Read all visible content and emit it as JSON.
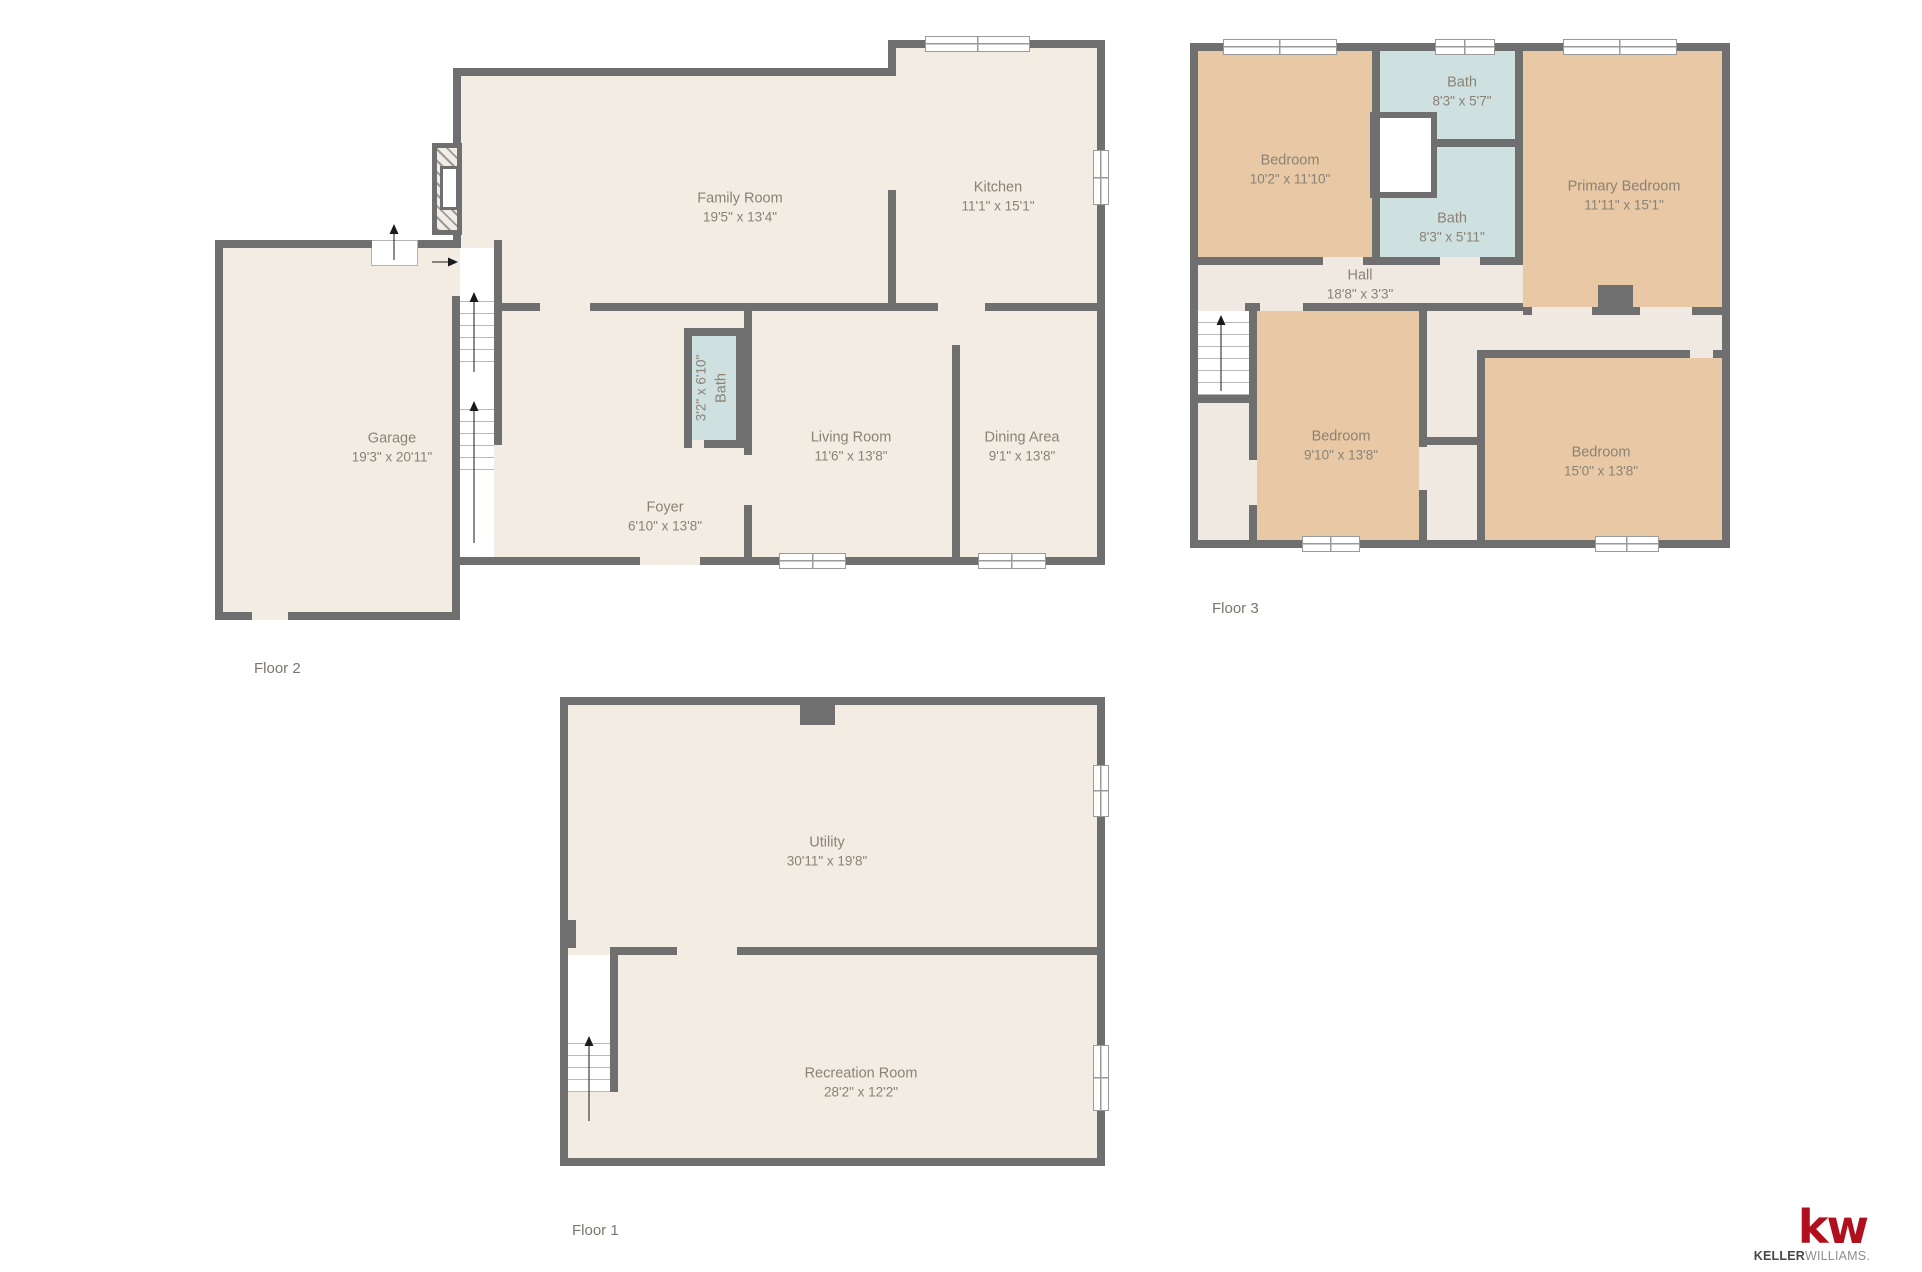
{
  "colors": {
    "wall": "#6f6f6f",
    "room_fill": "#f2ece3",
    "circulation_fill": "#efe9e1",
    "bedroom_fill": "#e9c9a5",
    "bath_fill": "#cfe0e1",
    "label_text": "#8b8275",
    "floor_label_text": "#7c766c",
    "kw_red": "#b0101e"
  },
  "floors": {
    "floor1": {
      "label": "Floor 1"
    },
    "floor2": {
      "label": "Floor 2"
    },
    "floor3": {
      "label": "Floor 3"
    }
  },
  "rooms": {
    "family_room": {
      "name": "Family Room",
      "dims": "19'5\" x 13'4\""
    },
    "kitchen": {
      "name": "Kitchen",
      "dims": "11'1\" x 15'1\""
    },
    "bath_f2": {
      "name": "Bath",
      "dims": "3'2\" x 6'10\""
    },
    "living_room": {
      "name": "Living Room",
      "dims": "11'6\" x 13'8\""
    },
    "dining_area": {
      "name": "Dining Area",
      "dims": "9'1\" x 13'8\""
    },
    "foyer": {
      "name": "Foyer",
      "dims": "6'10\" x 13'8\""
    },
    "garage": {
      "name": "Garage",
      "dims": "19'3\" x 20'11\""
    },
    "bedroom_tl": {
      "name": "Bedroom",
      "dims": "10'2\" x 11'10\""
    },
    "bath_upper": {
      "name": "Bath",
      "dims": "8'3\" x 5'7\""
    },
    "primary_bedroom": {
      "name": "Primary Bedroom",
      "dims": "11'11\" x 15'1\""
    },
    "bath_lower": {
      "name": "Bath",
      "dims": "8'3\" x 5'11\""
    },
    "hall": {
      "name": "Hall",
      "dims": "18'8\" x 3'3\""
    },
    "bedroom_bl": {
      "name": "Bedroom",
      "dims": "9'10\" x 13'8\""
    },
    "bedroom_br": {
      "name": "Bedroom",
      "dims": "15'0\" x 13'8\""
    },
    "utility": {
      "name": "Utility",
      "dims": "30'11\" x 19'8\""
    },
    "recreation_room": {
      "name": "Recreation Room",
      "dims": "28'2\" x 12'2\""
    }
  },
  "logo": {
    "mark": "kw",
    "name_primary": "KELLER",
    "name_secondary": "WILLIAMS."
  }
}
